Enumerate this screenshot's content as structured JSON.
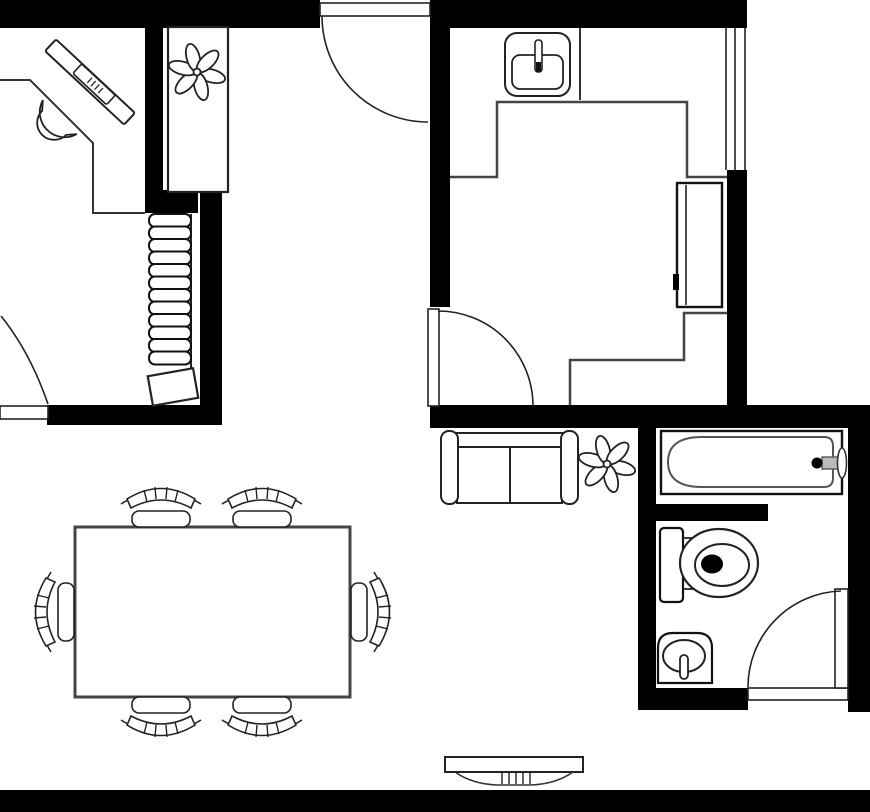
{
  "document": {
    "kind": "floor-plan",
    "units": "none",
    "text_labels": []
  },
  "palette": {
    "wall": "#000000",
    "line": "#222222",
    "line_soft": "#444444",
    "background": "#ffffff"
  },
  "rooms": [
    {
      "id": "office",
      "position": "top-left",
      "fixtures": [
        "corner-desk",
        "laptop",
        "desk-chair",
        "door-bottom-left"
      ]
    },
    {
      "id": "stair-closet",
      "position": "top-left-inner",
      "fixtures": [
        "shelf-cabinet",
        "potted-plant",
        "staircase",
        "floor-mat"
      ]
    },
    {
      "id": "hallway",
      "position": "top-center",
      "fixtures": [
        "entry-door"
      ]
    },
    {
      "id": "kitchen",
      "position": "top-right",
      "fixtures": [
        "kitchen-sink",
        "counter-top",
        "counter-bottom",
        "refrigerator",
        "window-right-wall",
        "interior-door"
      ]
    },
    {
      "id": "bathroom",
      "position": "right",
      "fixtures": [
        "bathtub",
        "bath-faucet",
        "toilet",
        "vanity-sink",
        "bathroom-door",
        "partition-wall"
      ]
    },
    {
      "id": "living-dining",
      "position": "bottom-left",
      "fixtures": [
        "sofa-loveseat",
        "potted-plant",
        "dining-table",
        "dining-chair-x6",
        "tv-console"
      ]
    }
  ],
  "counts": {
    "doors": 4,
    "windows": 1,
    "plants": 2,
    "dining_chairs": 6,
    "stair_treads": 12
  }
}
